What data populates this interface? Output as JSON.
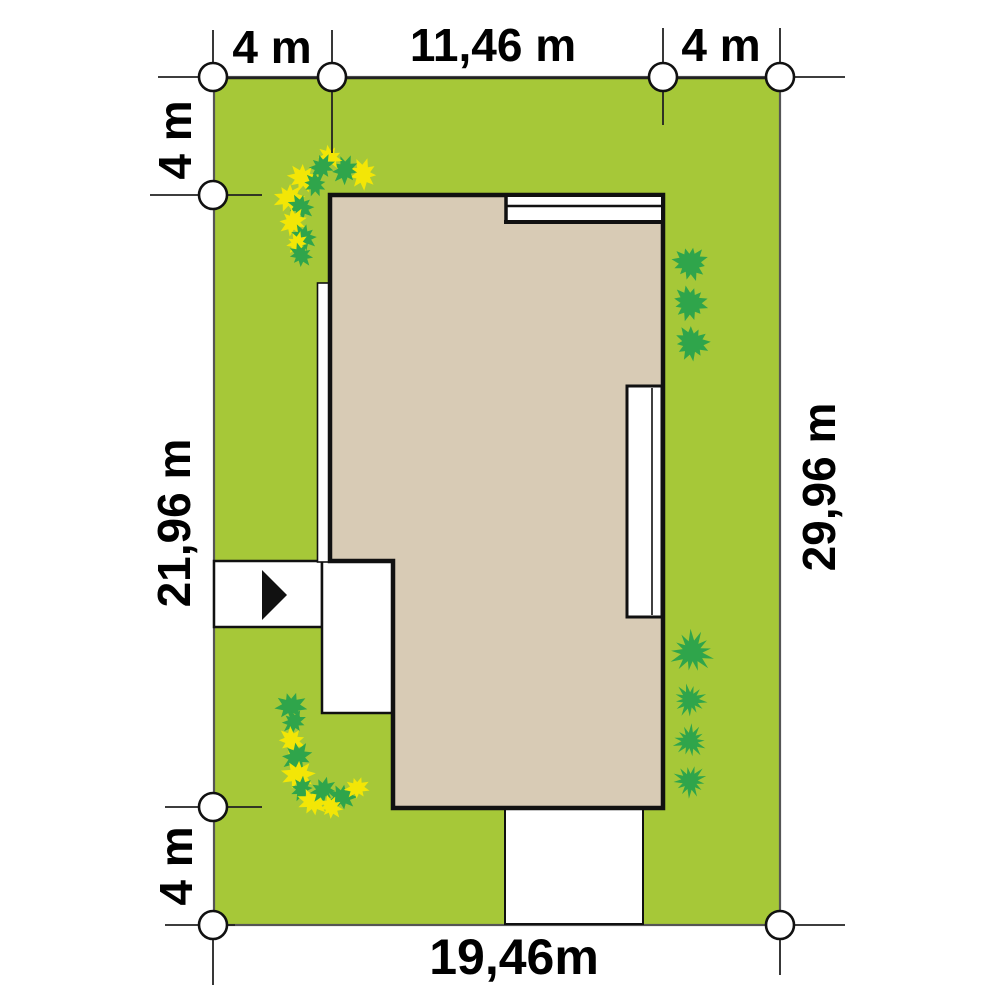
{
  "plan": {
    "dimensions": {
      "top_left": "4 m",
      "top_center": "11,46 m",
      "top_right": "4 m",
      "left_upper": "4 m",
      "left_middle": "21,96 m",
      "left_lower": "4 m",
      "right_side": "29,96 m",
      "bottom": "19,46m"
    },
    "colors": {
      "lawn": "#a6c838",
      "house_fill": "#d8cbb5",
      "bush_green": "#2fa54b",
      "flower_yellow": "#f3e606",
      "paving_white": "#ffffff",
      "outline_black": "#111111",
      "label_black": "#000000"
    }
  }
}
